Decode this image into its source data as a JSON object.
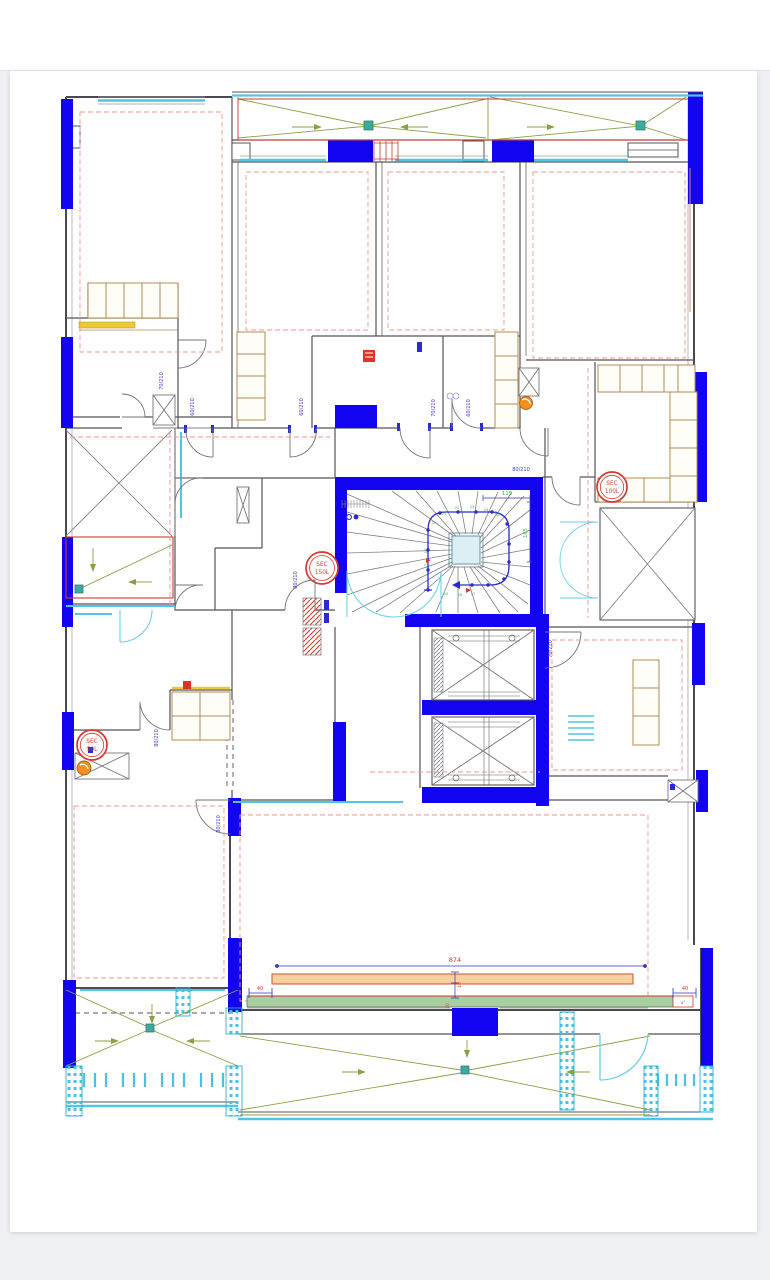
{
  "page": {
    "background": "#eef0f3",
    "sheet_background": "#ffffff"
  },
  "drawing": {
    "type": "architectural-floor-plan",
    "description": "Apartment floor plan: central winding stair, twin elevator shafts, perimeter balconies and terraces, blue structural columns",
    "colors": {
      "structural_column": "#1203f0",
      "wall": "#4a4a50",
      "window_cyan": "#4ec7e6",
      "balcony_marking_green": "#8aa044",
      "dimension_red": "#d9382c",
      "dimension_blue": "#3333bb",
      "door_label_blue": "#3c3ccc",
      "stair_green": "#3cb344",
      "cabinet_tan": "#b48b55",
      "guide_dashed_salmon": "#f0998a",
      "beam_fill": "#f8d0a0",
      "slab_fill": "#a8cf9f",
      "counter_yellow": "#ecc937",
      "boiler_orange": "#f09022"
    },
    "sec_tanks": [
      "SEC 150L",
      "SEC 100L",
      "SEC 50L"
    ],
    "door_sizes": [
      "80/210",
      "70/210",
      "60/210"
    ],
    "dimensions": {
      "beam_length": "874",
      "edge_offsets": [
        "40",
        "40"
      ],
      "beam_section": [
        "10",
        "30"
      ],
      "stair_width": "115",
      "stair_depth": "165",
      "stair_radius": "90",
      "slab_edge_note": "a°"
    },
    "stair_step_numbers": [
      "17",
      "18",
      "19",
      "20",
      "21",
      "22",
      "23",
      "24",
      "25",
      "26",
      "27"
    ],
    "labels": [
      {
        "t": "874",
        "x": 455,
        "y": 962,
        "c": "red",
        "s": 6.5
      },
      {
        "t": "40",
        "x": 260,
        "y": 990,
        "c": "red",
        "s": 5
      },
      {
        "t": "40",
        "x": 685,
        "y": 990,
        "c": "red",
        "s": 5
      },
      {
        "t": "10",
        "x": 461,
        "y": 985,
        "r": -90,
        "c": "red",
        "s": 4.5
      },
      {
        "t": "30",
        "x": 449,
        "y": 1006,
        "r": -90,
        "c": "red",
        "s": 4.5
      },
      {
        "t": "a°",
        "x": 683,
        "y": 1004,
        "c": "red",
        "s": 4
      },
      {
        "t": "115",
        "x": 507,
        "y": 495,
        "c": "green",
        "s": 5.5
      },
      {
        "t": "165",
        "x": 527,
        "y": 533,
        "r": -90,
        "c": "green",
        "s": 5
      },
      {
        "t": "90",
        "x": 496,
        "y": 515,
        "r": 35,
        "c": "green",
        "s": 4.5
      },
      {
        "t": "80/210",
        "x": 521,
        "y": 471,
        "c": "blue",
        "s": 5
      },
      {
        "t": "80/210",
        "x": 297,
        "y": 580,
        "r": -90,
        "c": "blue",
        "s": 5
      },
      {
        "t": "80/210",
        "x": 158,
        "y": 738,
        "r": -90,
        "c": "blue",
        "s": 5
      },
      {
        "t": "80/210",
        "x": 220,
        "y": 824,
        "r": -90,
        "c": "blue",
        "s": 5
      },
      {
        "t": "70/210",
        "x": 435,
        "y": 408,
        "r": -90,
        "c": "blue",
        "s": 5
      },
      {
        "t": "60/210",
        "x": 470,
        "y": 408,
        "r": -90,
        "c": "blue",
        "s": 5
      },
      {
        "t": "60/210",
        "x": 194,
        "y": 407,
        "r": -90,
        "c": "blue",
        "s": 5
      },
      {
        "t": "60/210",
        "x": 303,
        "y": 407,
        "r": -90,
        "c": "blue",
        "s": 5
      },
      {
        "t": "70/210",
        "x": 163,
        "y": 381,
        "r": -90,
        "c": "blue",
        "s": 5
      },
      {
        "t": "70/210",
        "x": 552,
        "y": 649,
        "r": -90,
        "c": "blue",
        "s": 5
      },
      {
        "t": "SEC",
        "x": 322,
        "y": 566,
        "c": "red",
        "s": 5.8
      },
      {
        "t": "150L",
        "x": 322,
        "y": 574,
        "c": "red",
        "s": 5.8
      },
      {
        "t": "SEC",
        "x": 612,
        "y": 485,
        "c": "red",
        "s": 5.8
      },
      {
        "t": "100L",
        "x": 612,
        "y": 493,
        "c": "red",
        "s": 5.8
      },
      {
        "t": "SEC",
        "x": 92,
        "y": 743,
        "c": "red",
        "s": 5.8
      },
      {
        "t": "50L",
        "x": 92,
        "y": 751,
        "c": "red",
        "s": 5.8
      },
      {
        "t": "19",
        "x": 429,
        "y": 537,
        "c": "green",
        "s": 3.6
      },
      {
        "t": "20",
        "x": 434,
        "y": 524,
        "c": "green",
        "s": 3.6
      },
      {
        "t": "21",
        "x": 444,
        "y": 515,
        "c": "green",
        "s": 3.6
      },
      {
        "t": "22",
        "x": 457,
        "y": 509,
        "c": "green",
        "s": 3.6
      },
      {
        "t": "23",
        "x": 472,
        "y": 508,
        "c": "green",
        "s": 3.6
      },
      {
        "t": "24",
        "x": 486,
        "y": 511,
        "c": "green",
        "s": 3.6
      },
      {
        "t": "25",
        "x": 446,
        "y": 595,
        "c": "green",
        "s": 3.6
      },
      {
        "t": "26",
        "x": 460,
        "y": 596,
        "c": "green",
        "s": 3.6
      },
      {
        "t": "27",
        "x": 473,
        "y": 595,
        "c": "green",
        "s": 3.6
      },
      {
        "t": "18",
        "x": 427,
        "y": 551,
        "r": -90,
        "c": "green",
        "s": 3.6
      },
      {
        "t": "17",
        "x": 427,
        "y": 566,
        "r": -90,
        "c": "green",
        "s": 3.6
      }
    ]
  }
}
